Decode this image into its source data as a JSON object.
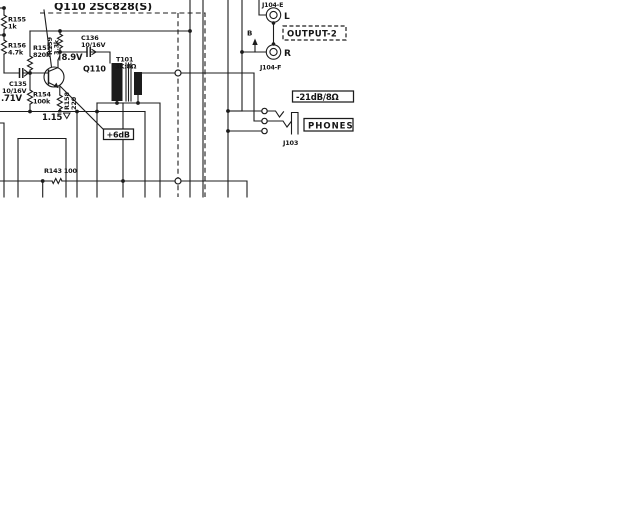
{
  "schematic": {
    "title": "Q110 2SC828(S)",
    "transistor": {
      "id": "Q110"
    },
    "voltages": {
      "collector": "8.9V",
      "base": ".71V",
      "emitter": "1.15"
    },
    "callouts": {
      "gain": "+6dB",
      "level": "-21dB/8Ω"
    },
    "components": {
      "r155": {
        "id": "R155",
        "value": "1k"
      },
      "r156": {
        "id": "R156",
        "value": "4.7k"
      },
      "r157": {
        "id": "R157",
        "value": "820k"
      },
      "r159": {
        "id": "R159",
        "value": "3.3k"
      },
      "r154": {
        "id": "R154",
        "value": "100k"
      },
      "r158": {
        "id": "R158",
        "value": "220"
      },
      "r143": {
        "id": "R143 100"
      },
      "c135": {
        "id": "C135",
        "value": "10/16V"
      },
      "c136": {
        "id": "C136",
        "value": "10/16V"
      },
      "t101": {
        "id": "T101",
        "value": "3K:8Ω"
      }
    },
    "connectors": {
      "j104e": "J104-E",
      "j104f": "J104-F",
      "j103": "J103",
      "left": "L",
      "right": "R",
      "point_b": "B",
      "output2": "OUTPUT-2",
      "phones": "PHONES"
    }
  }
}
